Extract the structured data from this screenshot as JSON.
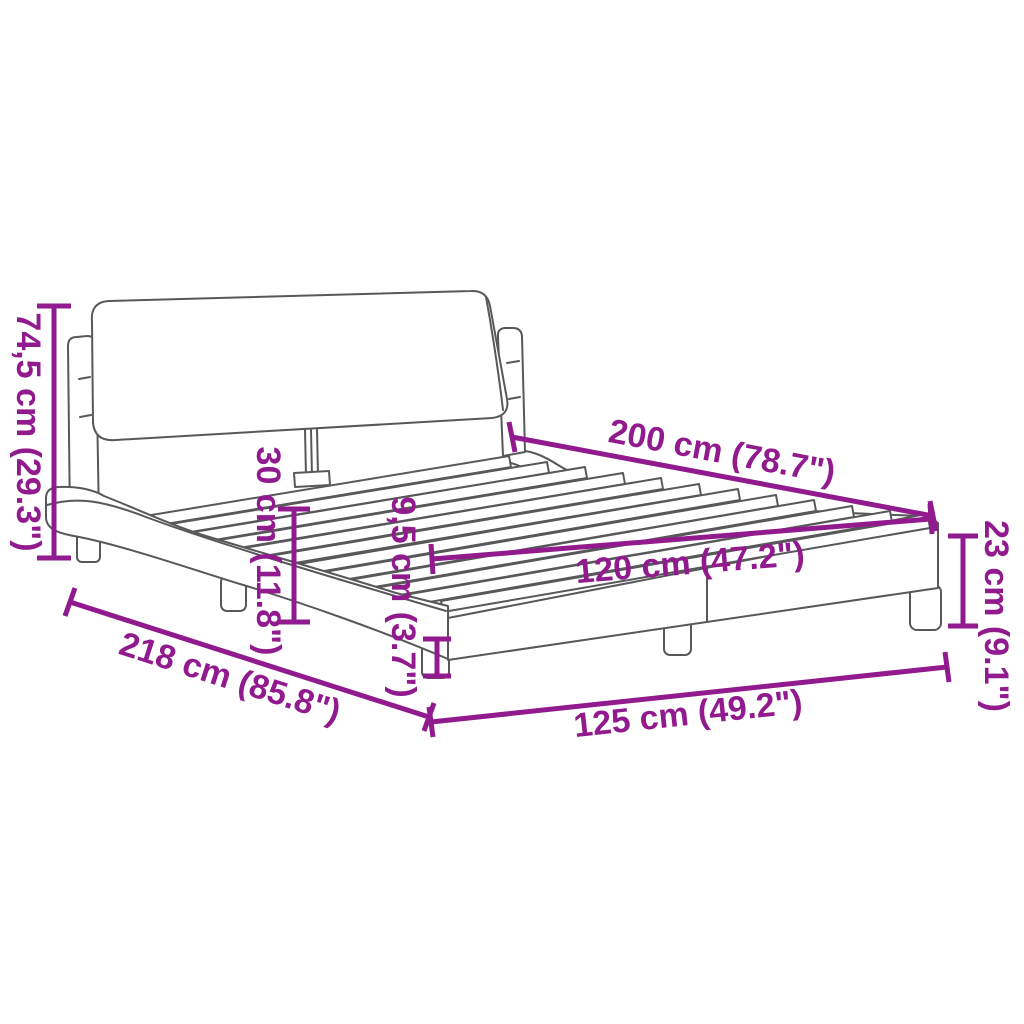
{
  "diagram": {
    "type": "product-dimension-diagram",
    "subject": "upholstered bed frame with headboard and slats",
    "colors": {
      "dimension_accent": "#911B8E",
      "drawing_outline": "#58585B",
      "background": "#FFFFFF"
    },
    "labels": {
      "headboard_height": "74,5 cm (29.3\")",
      "headboard_clearance": "30 cm (11.8\")",
      "rail_height": "9,5 cm (3.7\")",
      "length_inner": "200 cm (78.7\")",
      "width_inner": "120 cm (47.2\")",
      "frame_height": "23 cm (9.1\")",
      "length_outer": "218 cm (85.8\")",
      "width_outer": "125 cm (49.2\")"
    }
  }
}
